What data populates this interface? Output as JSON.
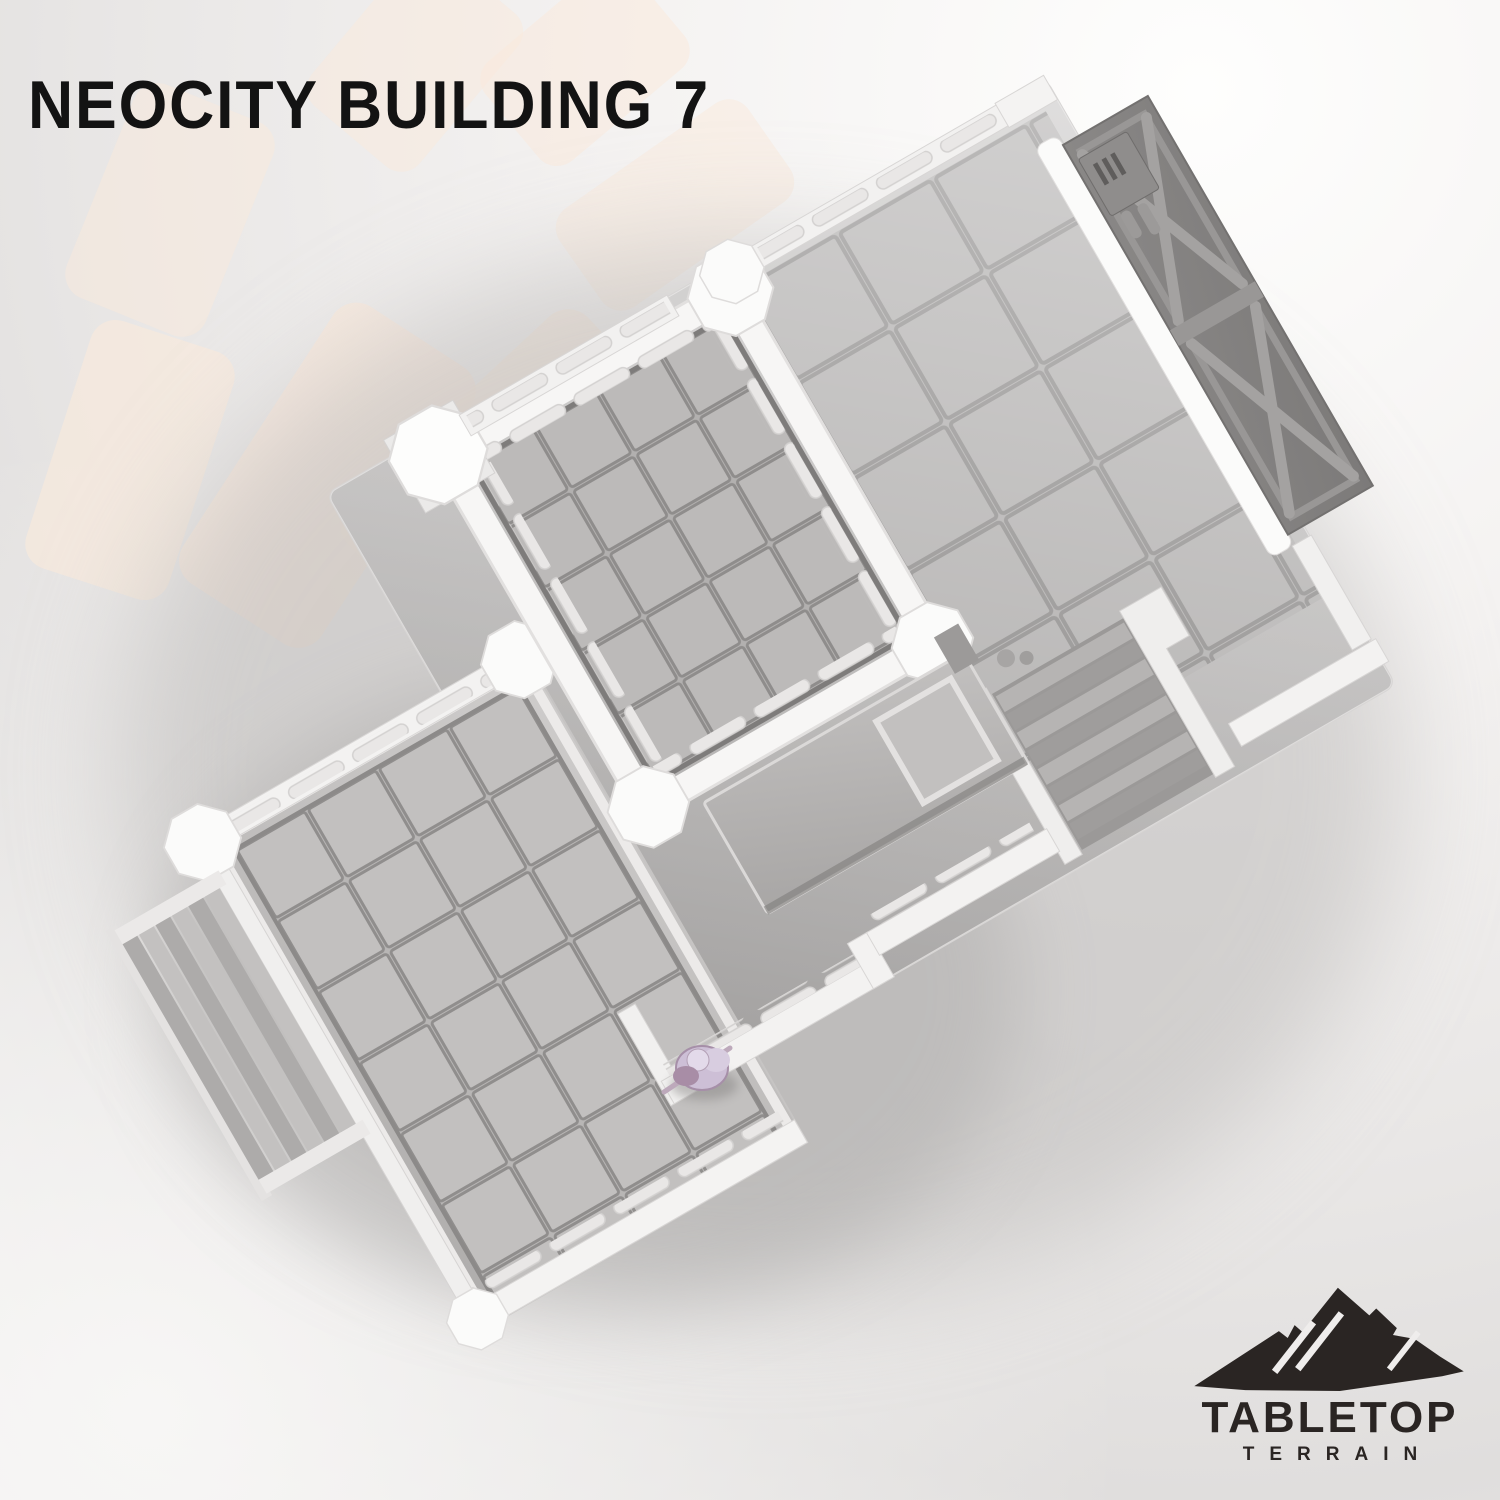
{
  "page": {
    "title": "NEOCITY BUILDING 7"
  },
  "brand": {
    "line1": "TABLETOP",
    "line2": "TERRAIN",
    "icon": "mountain-icon"
  },
  "scene": {
    "subject": "Top-down isometric 3D render of a modular sci-fi building terrain kit",
    "elements": [
      "raised tiled room with white bumper walls and octagonal corner pillars",
      "large tiled hall on the right",
      "cross-braced blast-door wall panel with vent greeble",
      "central staircase to lower floor",
      "outer staircase on the left terrace",
      "lower tiled terrace platform",
      "entrance canopy with skylight",
      "pink hero miniature for scale"
    ],
    "miniature_color": "#cdbfd6"
  },
  "colors": {
    "background_top": "#fefefd",
    "background_mid": "#e9e7e6",
    "ray_accent": "#f9e9dc",
    "title_text": "#131313",
    "logo_ink": "#2a2523",
    "wall_white": "#f6f5f4",
    "floor_light": "#c6c4c3",
    "floor_dark": "#9f9d9c",
    "panel_gray": "#8e8c8b",
    "tile_line": "#8f8d8c"
  }
}
